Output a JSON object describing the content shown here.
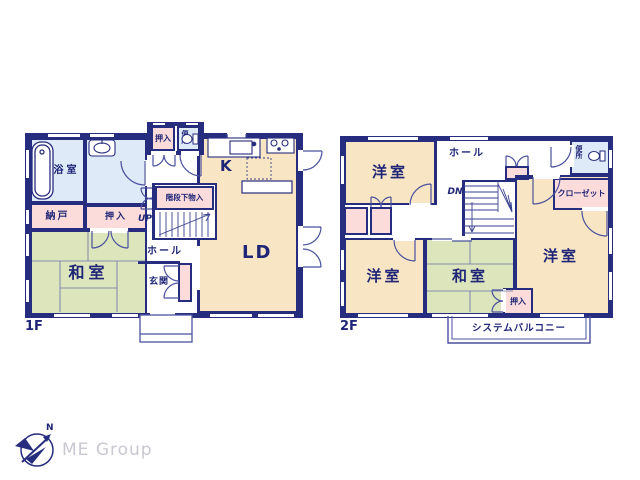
{
  "colors": {
    "wall": "#262c7e",
    "text": "#1f2577",
    "wood_floor": "#f8e5c3",
    "tatami_floor": "#dde5bd",
    "closet_fill": "#fbdcda",
    "wet_area_fill": "#dfeaf8",
    "logo_text": "#c8c9d2"
  },
  "floor1": {
    "label": "1F",
    "rooms": {
      "bath": "浴室",
      "storage": "納戸",
      "closet": "押入",
      "closet_top": "押入",
      "toilet": "便所",
      "understair_storage": "階段下物入",
      "tatami_room": "和室",
      "hall": "ホール",
      "entrance": "玄関",
      "kitchen": "K",
      "living_dining": "LD",
      "stairs_up": "UP"
    }
  },
  "floor2": {
    "label": "2F",
    "rooms": {
      "western_room_top": "洋室",
      "western_room_left": "洋室",
      "western_room_right": "洋室",
      "tatami_room": "和室",
      "closet_small": "押入",
      "walk_in_closet": "クローゼット",
      "toilet": "便所",
      "hall": "ホール",
      "stairs_down": "DN",
      "balcony": "システムバルコニー"
    }
  },
  "logo": {
    "company": "ME Group",
    "compass_north": "N"
  }
}
